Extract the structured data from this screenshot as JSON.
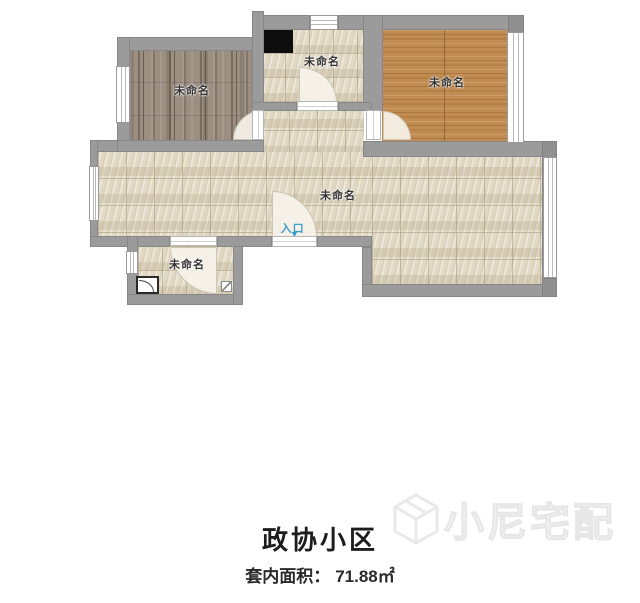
{
  "plan": {
    "rooms": {
      "bedroom_left": {
        "label": "未命名"
      },
      "kitchen": {
        "label": "未命名"
      },
      "bedroom_right": {
        "label": "未命名"
      },
      "living_room": {
        "label": "未命名"
      },
      "bathroom": {
        "label": "未命名"
      }
    },
    "entrance": {
      "label": "入口",
      "arrow_icon": "▼"
    }
  },
  "footer": {
    "community_name": "政协小区",
    "area_label": "套内面积：",
    "area_value": "71.88㎡"
  },
  "watermark": {
    "brand_text": "小尼宅配"
  },
  "colors": {
    "wall_gray": "#9b9b9b",
    "tile_floor_beige": "#e4ddcc",
    "wood_floor_gray_brown": "#9c8f82",
    "wood_floor_warm_brown": "#c18c52",
    "entrance_accent_blue": "#3f9fc7",
    "stove_black": "#0d0d0d",
    "title_text": "#1d1d1d",
    "watermark_light_gray": "#e7e7e7"
  }
}
